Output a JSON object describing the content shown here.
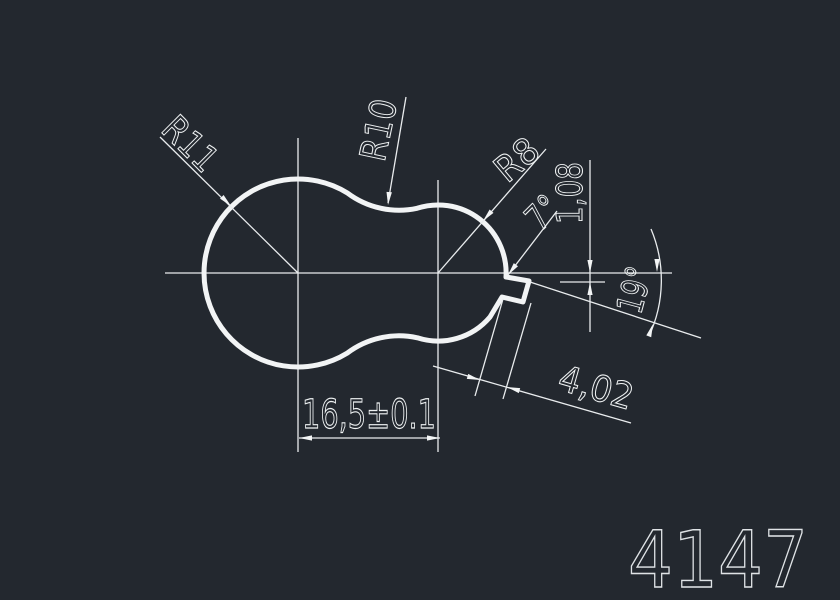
{
  "canvas": {
    "background_color": "#23282f",
    "line_color": "#f2f4f5"
  },
  "dimensions": {
    "radius_left": "R11",
    "radius_top": "R10",
    "radius_right": "R8",
    "notch_angle": "7°",
    "notch_offset": "1,08",
    "key_angle": "19°",
    "key_width": "4,02",
    "center_distance": "16,5±0.1"
  },
  "part_number": "4147"
}
